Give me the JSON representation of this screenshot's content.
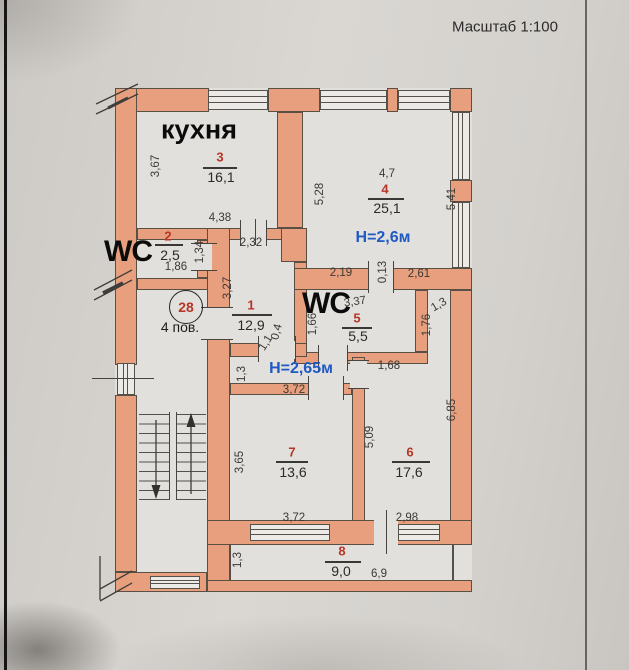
{
  "scale_title": "Масштаб 1:100",
  "stair_marker": {
    "apartment": "28",
    "floor": "4 пов."
  },
  "room_labels": {
    "kitchen": "кухня",
    "wc_left": "WC",
    "wc_middle": "WC"
  },
  "heights": {
    "room4": "Н=2,6м",
    "hallway": "Н=2,65м"
  },
  "rooms": [
    {
      "number": "3",
      "area": "16,1"
    },
    {
      "number": "2",
      "area": "2,5"
    },
    {
      "number": "4",
      "area": "25,1"
    },
    {
      "number": "1",
      "area": "12,9"
    },
    {
      "number": "5",
      "area": "5,5"
    },
    {
      "number": "7",
      "area": "13,6"
    },
    {
      "number": "6",
      "area": "17,6"
    },
    {
      "number": "8",
      "area": "9,0"
    }
  ],
  "dimensions": [
    "3,67",
    "4,38",
    "2,32",
    "1,34",
    "1,86",
    "3,27",
    "4,7",
    "5,28",
    "5,41",
    "2,19",
    "0,13",
    "2,61",
    "3,37",
    "1,66",
    "1,76",
    "1,3",
    "1,68",
    "1,1",
    "0,4",
    "1,3",
    "3,72",
    "3,65",
    "3,72",
    "5,09",
    "2,98",
    "6,85",
    "1,3",
    "6,9"
  ],
  "colors": {
    "wall": "#e89f7d",
    "room_number_red": "#b63527",
    "height_blue": "#1e59c4"
  }
}
